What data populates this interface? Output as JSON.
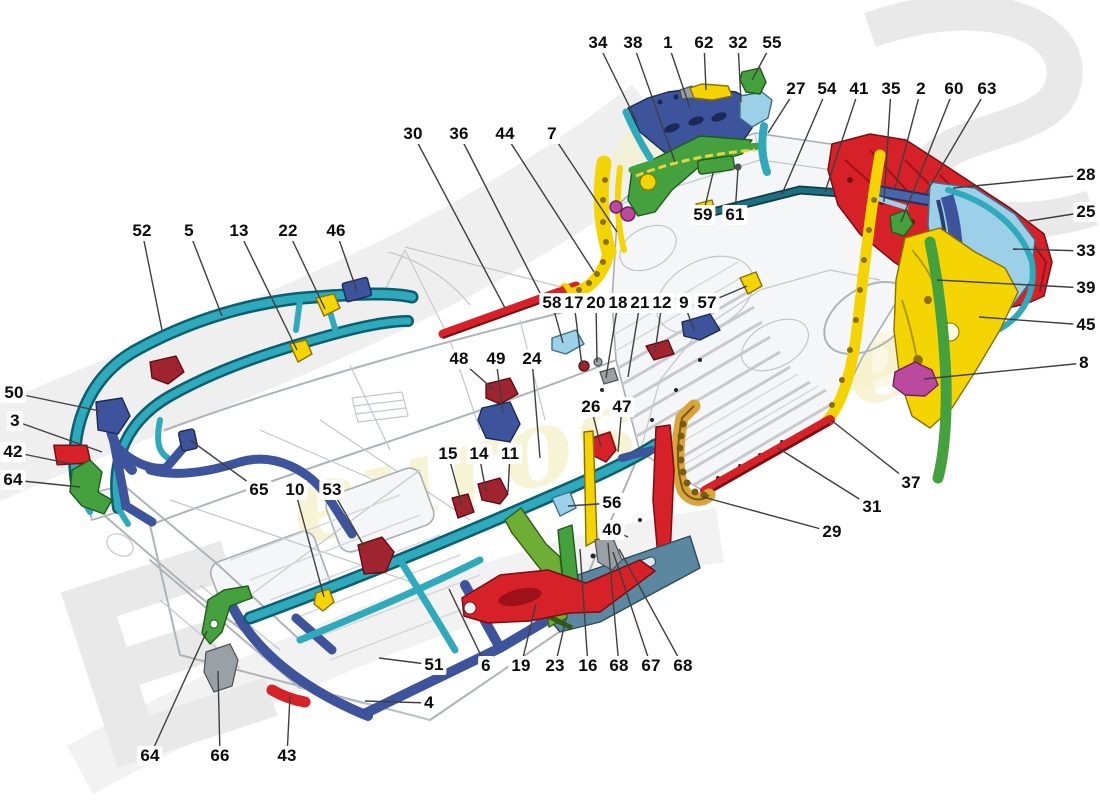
{
  "figure": {
    "kind": "exploded parts diagram",
    "background": "#ffffff"
  },
  "watermark": {
    "script_text": "eurospares",
    "letter_bottom_left": "E",
    "letter_top_right": "S",
    "gray": "#e9e9e9",
    "pale_yellow": "#f3edba"
  },
  "colors": {
    "cyan": "#2fa9bc",
    "darkblue": "#3d549c",
    "steelblue": "#5b87a0",
    "lightblue": "#9bd0e8",
    "red": "#d62128",
    "darkred": "#a02330",
    "yellow": "#f4d503",
    "amber": "#d9a43c",
    "green": "#44a13e",
    "lightgreen": "#6fae35",
    "magenta": "#bb4a9e",
    "navyrod": "#1d6f80",
    "leader": "#3f3f3f",
    "label_text": "#0b0b0b",
    "lineart": "#aeb4b8"
  },
  "callouts": [
    {
      "n": "34",
      "x": 598,
      "y": 43,
      "tx": 637,
      "ty": 122
    },
    {
      "n": "38",
      "x": 633,
      "y": 43,
      "tx": 675,
      "ty": 162
    },
    {
      "n": "1",
      "x": 668,
      "y": 43,
      "tx": 690,
      "ty": 108
    },
    {
      "n": "62",
      "x": 704,
      "y": 43,
      "tx": 706,
      "ty": 90
    },
    {
      "n": "32",
      "x": 738,
      "y": 43,
      "tx": 741,
      "ty": 102
    },
    {
      "n": "55",
      "x": 772,
      "y": 43,
      "tx": 752,
      "ty": 80
    },
    {
      "n": "27",
      "x": 796,
      "y": 89,
      "tx": 768,
      "ty": 133
    },
    {
      "n": "54",
      "x": 827,
      "y": 89,
      "tx": 782,
      "ty": 194
    },
    {
      "n": "41",
      "x": 859,
      "y": 89,
      "tx": 825,
      "ty": 192
    },
    {
      "n": "35",
      "x": 891,
      "y": 89,
      "tx": 884,
      "ty": 202
    },
    {
      "n": "2",
      "x": 921,
      "y": 89,
      "tx": 895,
      "ty": 188
    },
    {
      "n": "60",
      "x": 954,
      "y": 89,
      "tx": 901,
      "ty": 222
    },
    {
      "n": "63",
      "x": 987,
      "y": 89,
      "tx": 926,
      "ty": 193
    },
    {
      "n": "30",
      "x": 413,
      "y": 134,
      "tx": 505,
      "ty": 308
    },
    {
      "n": "36",
      "x": 459,
      "y": 134,
      "tx": 540,
      "ty": 293
    },
    {
      "n": "44",
      "x": 505,
      "y": 134,
      "tx": 594,
      "ty": 272
    },
    {
      "n": "7",
      "x": 552,
      "y": 134,
      "tx": 617,
      "ty": 232
    },
    {
      "n": "28",
      "x": 1086,
      "y": 175,
      "tx": 953,
      "ty": 188
    },
    {
      "n": "25",
      "x": 1086,
      "y": 212,
      "tx": 1029,
      "ty": 221
    },
    {
      "n": "33",
      "x": 1086,
      "y": 251,
      "tx": 1013,
      "ty": 249
    },
    {
      "n": "39",
      "x": 1086,
      "y": 288,
      "tx": 937,
      "ty": 280
    },
    {
      "n": "45",
      "x": 1086,
      "y": 325,
      "tx": 979,
      "ty": 317
    },
    {
      "n": "8",
      "x": 1084,
      "y": 363,
      "tx": 924,
      "ty": 379
    },
    {
      "n": "52",
      "x": 142,
      "y": 231,
      "tx": 162,
      "ty": 330
    },
    {
      "n": "5",
      "x": 189,
      "y": 231,
      "tx": 222,
      "ty": 316
    },
    {
      "n": "13",
      "x": 239,
      "y": 231,
      "tx": 297,
      "ty": 350
    },
    {
      "n": "22",
      "x": 288,
      "y": 231,
      "tx": 325,
      "ty": 309
    },
    {
      "n": "46",
      "x": 336,
      "y": 231,
      "tx": 357,
      "ty": 291
    },
    {
      "n": "59",
      "x": 703,
      "y": 215,
      "tx": 713,
      "ty": 173
    },
    {
      "n": "61",
      "x": 735,
      "y": 215,
      "tx": 738,
      "ty": 169
    },
    {
      "n": "58",
      "x": 552,
      "y": 303,
      "tx": 563,
      "ty": 343
    },
    {
      "n": "17",
      "x": 574,
      "y": 303,
      "tx": 582,
      "ty": 366
    },
    {
      "n": "20",
      "x": 596,
      "y": 303,
      "tx": 597,
      "ty": 362
    },
    {
      "n": "18",
      "x": 618,
      "y": 303,
      "tx": 606,
      "ty": 378
    },
    {
      "n": "21",
      "x": 640,
      "y": 303,
      "tx": 628,
      "ty": 377
    },
    {
      "n": "12",
      "x": 662,
      "y": 303,
      "tx": 655,
      "ty": 352
    },
    {
      "n": "9",
      "x": 684,
      "y": 303,
      "tx": 694,
      "ty": 330
    },
    {
      "n": "57",
      "x": 707,
      "y": 303,
      "tx": 747,
      "ty": 286
    },
    {
      "n": "48",
      "x": 459,
      "y": 359,
      "tx": 494,
      "ty": 390
    },
    {
      "n": "49",
      "x": 496,
      "y": 359,
      "tx": 503,
      "ty": 413
    },
    {
      "n": "24",
      "x": 532,
      "y": 359,
      "tx": 540,
      "ty": 458
    },
    {
      "n": "26",
      "x": 591,
      "y": 407,
      "tx": 601,
      "ty": 447
    },
    {
      "n": "47",
      "x": 622,
      "y": 407,
      "tx": 618,
      "ty": 452
    },
    {
      "n": "15",
      "x": 448,
      "y": 454,
      "tx": 462,
      "ty": 505
    },
    {
      "n": "14",
      "x": 479,
      "y": 454,
      "tx": 486,
      "ty": 492
    },
    {
      "n": "11",
      "x": 510,
      "y": 454,
      "tx": 508,
      "ty": 492
    },
    {
      "n": "50",
      "x": 14,
      "y": 393,
      "tx": 100,
      "ty": 411
    },
    {
      "n": "3",
      "x": 15,
      "y": 421,
      "tx": 102,
      "ty": 452
    },
    {
      "n": "42",
      "x": 13,
      "y": 452,
      "tx": 72,
      "ty": 464
    },
    {
      "n": "64",
      "x": 13,
      "y": 480,
      "tx": 80,
      "ty": 487
    },
    {
      "n": "65",
      "x": 259,
      "y": 490,
      "tx": 190,
      "ty": 440
    },
    {
      "n": "10",
      "x": 295,
      "y": 490,
      "tx": 324,
      "ty": 597
    },
    {
      "n": "53",
      "x": 332,
      "y": 490,
      "tx": 364,
      "ty": 546
    },
    {
      "n": "56",
      "x": 612,
      "y": 503,
      "tx": 568,
      "ty": 506
    },
    {
      "n": "40",
      "x": 612,
      "y": 530,
      "tx": 628,
      "ty": 537
    },
    {
      "n": "37",
      "x": 911,
      "y": 483,
      "tx": 831,
      "ty": 420
    },
    {
      "n": "31",
      "x": 872,
      "y": 507,
      "tx": 778,
      "ty": 448
    },
    {
      "n": "29",
      "x": 832,
      "y": 532,
      "tx": 703,
      "ty": 497
    },
    {
      "n": "51",
      "x": 434,
      "y": 665,
      "tx": 379,
      "ty": 658
    },
    {
      "n": "4",
      "x": 429,
      "y": 703,
      "tx": 365,
      "ty": 701
    },
    {
      "n": "6",
      "x": 486,
      "y": 666,
      "tx": 449,
      "ty": 589
    },
    {
      "n": "19",
      "x": 521,
      "y": 666,
      "tx": 536,
      "ty": 604
    },
    {
      "n": "23",
      "x": 555,
      "y": 666,
      "tx": 566,
      "ty": 619
    },
    {
      "n": "16",
      "x": 588,
      "y": 666,
      "tx": 580,
      "ty": 549
    },
    {
      "n": "68",
      "x": 619,
      "y": 666,
      "tx": 608,
      "ty": 543
    },
    {
      "n": "67",
      "x": 651,
      "y": 666,
      "tx": 613,
      "ty": 552
    },
    {
      "n": "68",
      "x": 683,
      "y": 666,
      "tx": 619,
      "ty": 549
    },
    {
      "n": "64",
      "x": 150,
      "y": 756,
      "tx": 207,
      "ty": 631
    },
    {
      "n": "66",
      "x": 220,
      "y": 756,
      "tx": 218,
      "ty": 671
    },
    {
      "n": "43",
      "x": 287,
      "y": 756,
      "tx": 290,
      "ty": 696
    }
  ]
}
